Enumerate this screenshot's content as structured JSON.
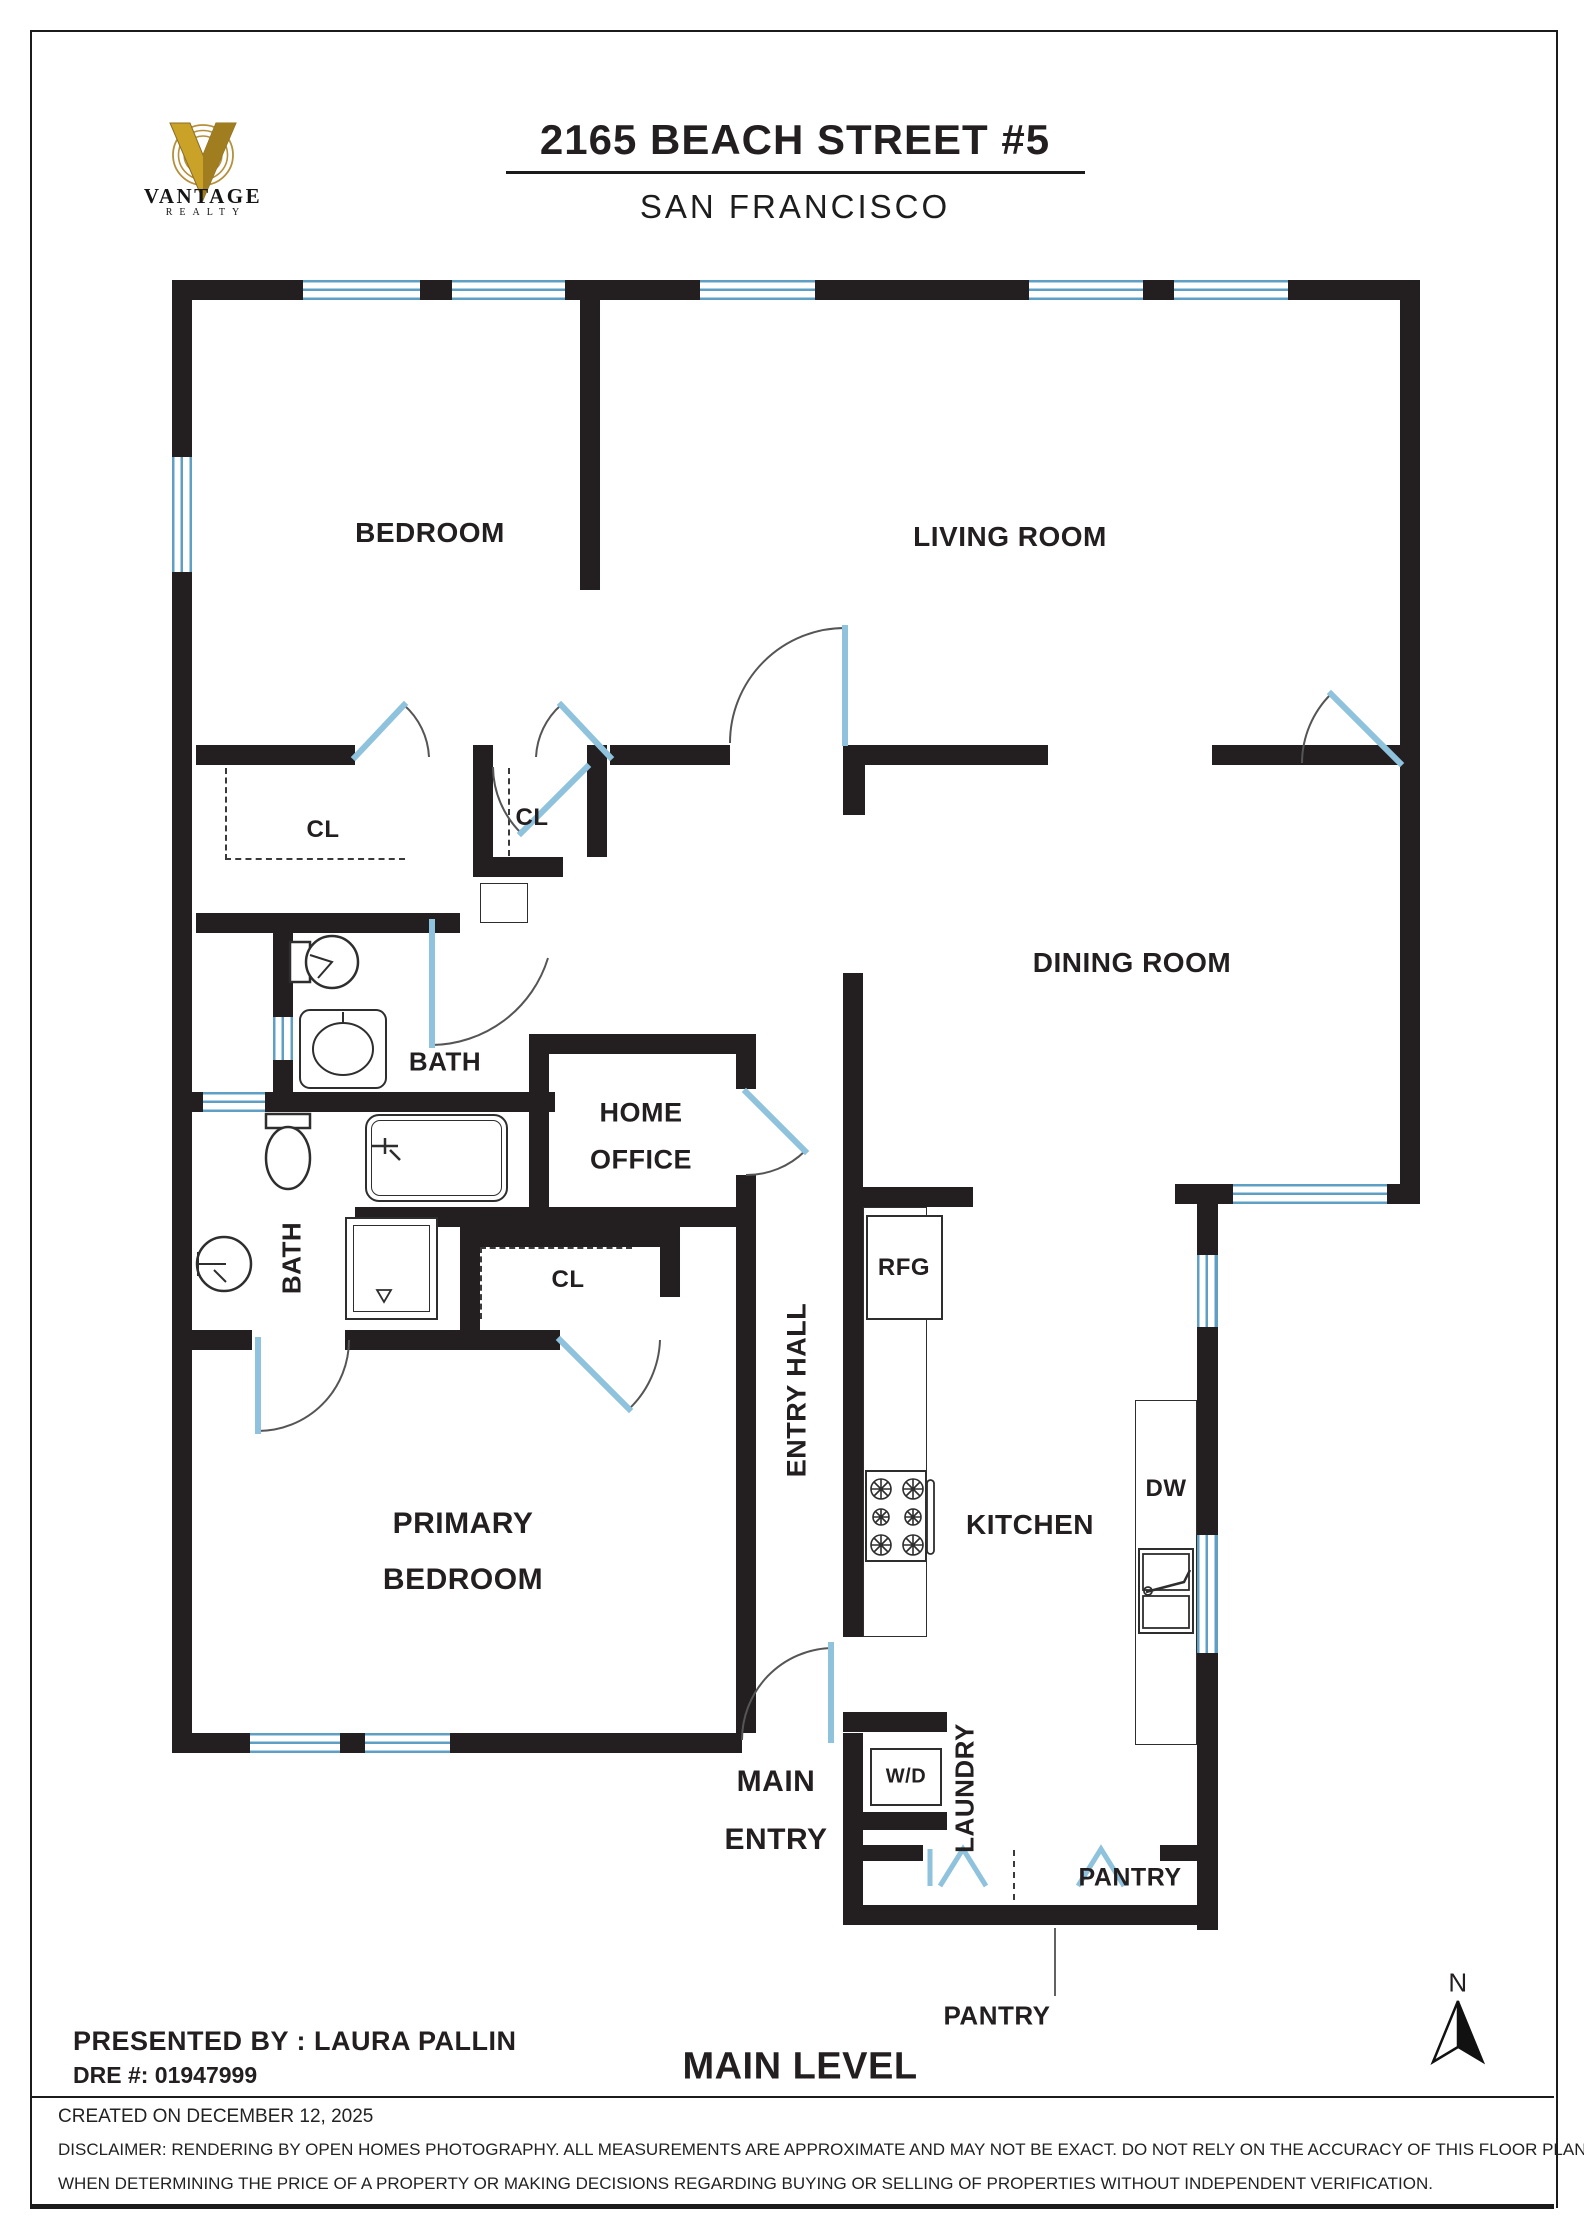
{
  "header": {
    "brand_name": "VANTAGE",
    "brand_sub": "REALTY",
    "title": "2165 BEACH STREET #5",
    "subtitle": "SAN FRANCISCO"
  },
  "plan": {
    "labels": {
      "bedroom": "BEDROOM",
      "living_room": "LIVING ROOM",
      "dining_room": "DINING ROOM",
      "kitchen": "KITCHEN",
      "primary_line1": "PRIMARY",
      "primary_line2": "BEDROOM",
      "home_office_line1": "HOME",
      "home_office_line2": "OFFICE",
      "entry_hall": "ENTRY HALL",
      "bath_upper": "BATH",
      "bath_lower": "BATH",
      "closet1": "CL",
      "closet2": "CL",
      "closet3": "CL",
      "rfg": "RFG",
      "dw": "DW",
      "wd": "W/D",
      "laundry": "LAUNDRY",
      "pantry_inside": "PANTRY",
      "pantry_callout": "PANTRY",
      "main_entry_line1": "MAIN",
      "main_entry_line2": "ENTRY",
      "level_title": "MAIN LEVEL"
    }
  },
  "compass": {
    "label": "N"
  },
  "footer": {
    "presented": "PRESENTED BY : LAURA PALLIN",
    "dre": "DRE #: 01947999",
    "created": "CREATED ON DECEMBER 12, 2025",
    "disclaimer1": "DISCLAIMER: RENDERING BY OPEN HOMES PHOTOGRAPHY. ALL MEASUREMENTS ARE APPROXIMATE AND MAY NOT BE EXACT. DO NOT RELY ON THE ACCURACY OF THIS FLOOR PLAN",
    "disclaimer2": "WHEN DETERMINING THE PRICE OF A PROPERTY OR MAKING DECISIONS REGARDING BUYING OR SELLING OF PROPERTIES WITHOUT INDEPENDENT VERIFICATION."
  },
  "colors": {
    "wall": "#231f20",
    "accent_blue": "#8fc2dc",
    "brand_gold": "#c9a227"
  }
}
